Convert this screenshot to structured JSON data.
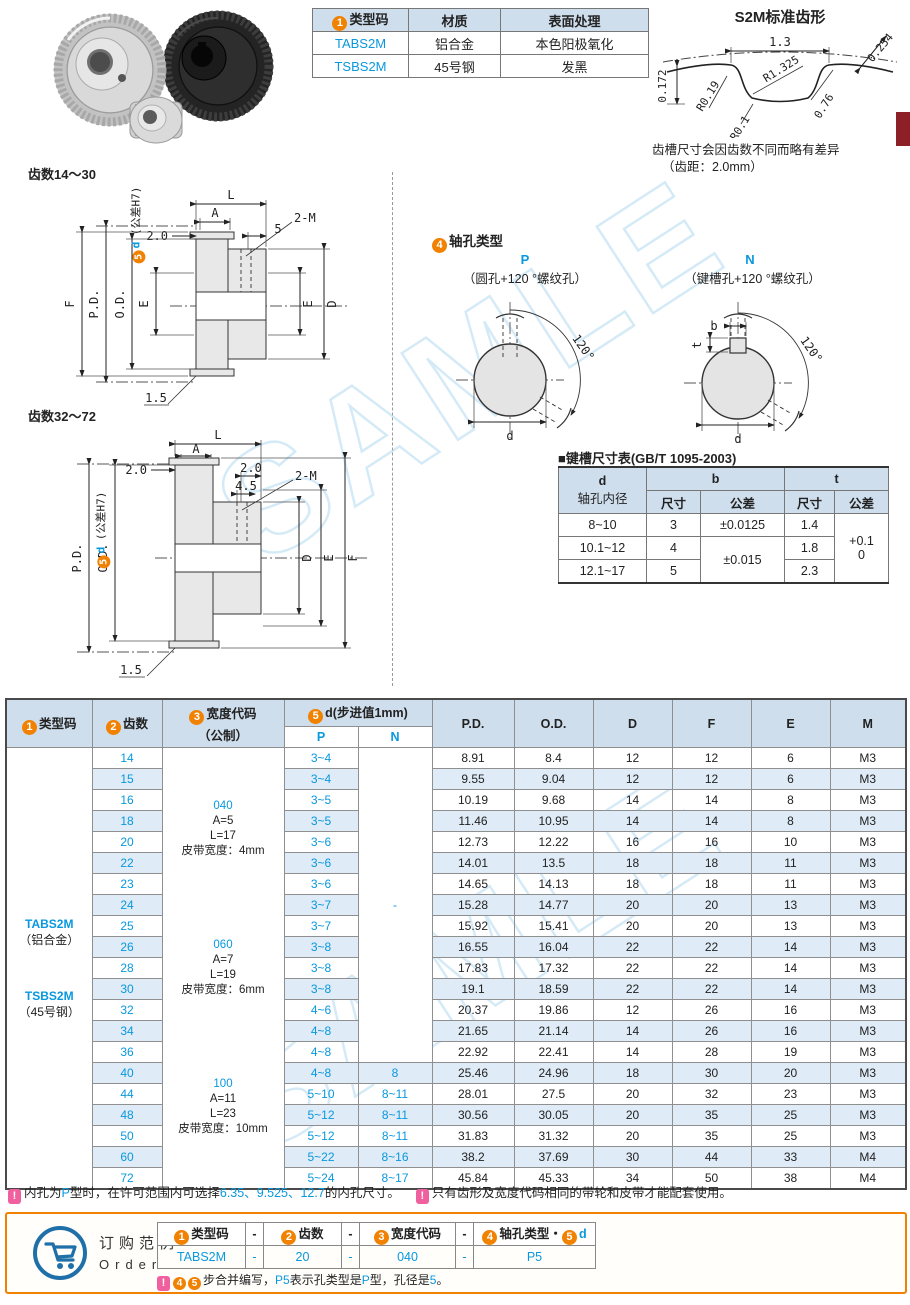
{
  "watermark": {
    "text": "SAMLE"
  },
  "spec_table": {
    "h1_num": "1",
    "h1": "类型码",
    "h2": "材质",
    "h3": "表面处理",
    "rows": [
      {
        "code": "TABS2M",
        "material": "铝合金",
        "finish": "本色阳极氧化"
      },
      {
        "code": "TSBS2M",
        "material": "45号钢",
        "finish": "发黑"
      }
    ]
  },
  "tooth_profile": {
    "title": "S2M标准齿形",
    "pitch": "1.3",
    "backlash": "0.254",
    "r_main": "R1.325",
    "r_left": "R0.19",
    "flank": "0.76",
    "height": "0.172",
    "r_bottom": "R0.1",
    "note1": "齿槽尺寸会因齿数不同而略有差异",
    "note2": "（齿距：2.0mm）"
  },
  "drawing_small": {
    "title": "齿数14～30",
    "l": "L",
    "a": "A",
    "left": "2.0",
    "right": "5",
    "screw": "2-M",
    "f": "F",
    "pd": "P.D.",
    "od": "O.D.",
    "e_left": "E",
    "e_right": "E",
    "d": "D",
    "flange": "1.5",
    "bore_num": "5",
    "bore_d": "d",
    "bore_tol": "(公差H7)"
  },
  "drawing_large": {
    "title": "齿数32～72",
    "l": "L",
    "a": "A",
    "left": "2.0",
    "right": "2.0",
    "right2": "4.5",
    "screw": "2-M",
    "f": "F",
    "pd": "P.D.",
    "od": "O.D.",
    "e": "E",
    "d": "D",
    "flange": "1.5",
    "bore_num": "5",
    "bore_d": "d",
    "bore_tol": "(公差H7)"
  },
  "shaft_hole": {
    "num": "4",
    "heading": "轴孔类型",
    "p": {
      "code": "P",
      "desc": "（圆孔+120 °螺纹孔）",
      "angle": "120°",
      "dim_d": "d"
    },
    "n": {
      "code": "N",
      "desc": "（键槽孔+120 °螺纹孔）",
      "angle": "120°",
      "dim_d": "d",
      "dim_b": "b",
      "dim_t": "t"
    }
  },
  "keyway_table": {
    "title": "■键槽尺寸表(GB/T 1095-2003)",
    "h_d": "d",
    "h_d2": "轴孔内径",
    "h_b": "b",
    "h_t": "t",
    "h_size": "尺寸",
    "h_tol": "公差",
    "rows": [
      {
        "d": "8~10",
        "b": "3",
        "t": "1.4"
      },
      {
        "d": "10.1~12",
        "b": "4",
        "t": "1.8"
      },
      {
        "d": "12.1~17",
        "b": "5",
        "t": "2.3"
      }
    ],
    "b_tol_row1": "±0.0125",
    "b_tol_row23": "±0.015",
    "t_tol_line1": "+0.1",
    "t_tol_line2": "0"
  },
  "main_table": {
    "h_type_num": "1",
    "h_type": "类型码",
    "h_teeth_num": "2",
    "h_teeth": "齿数",
    "h_width_num": "3",
    "h_width": "宽度代码",
    "h_width2": "（公制）",
    "h_d_num": "5",
    "h_d": "d(步进值1mm)",
    "h_p": "P",
    "h_n": "N",
    "h_cols": [
      "P.D.",
      "O.D.",
      "D",
      "F",
      "E",
      "M"
    ],
    "type_block": {
      "code1": "TABS2M",
      "mat1": "（铝合金）",
      "code2": "TSBS2M",
      "mat2": "（45号钢）"
    },
    "width_blocks": [
      {
        "code": "040",
        "a": "A=5",
        "l": "L=17",
        "belt": "皮带宽度：4mm"
      },
      {
        "code": "060",
        "a": "A=7",
        "l": "L=19",
        "belt": "皮带宽度：6mm"
      },
      {
        "code": "100",
        "a": "A=11",
        "l": "L=23",
        "belt": "皮带宽度：10mm"
      }
    ],
    "n_merged": "-",
    "rows": [
      {
        "teeth": "14",
        "p": "3~4",
        "pd": "8.91",
        "od": "8.4",
        "d": "12",
        "f": "12",
        "e": "6",
        "m": "M3"
      },
      {
        "teeth": "15",
        "p": "3~4",
        "pd": "9.55",
        "od": "9.04",
        "d": "12",
        "f": "12",
        "e": "6",
        "m": "M3"
      },
      {
        "teeth": "16",
        "p": "3~5",
        "pd": "10.19",
        "od": "9.68",
        "d": "14",
        "f": "14",
        "e": "8",
        "m": "M3"
      },
      {
        "teeth": "18",
        "p": "3~5",
        "pd": "11.46",
        "od": "10.95",
        "d": "14",
        "f": "14",
        "e": "8",
        "m": "M3"
      },
      {
        "teeth": "20",
        "p": "3~6",
        "pd": "12.73",
        "od": "12.22",
        "d": "16",
        "f": "16",
        "e": "10",
        "m": "M3"
      },
      {
        "teeth": "22",
        "p": "3~6",
        "pd": "14.01",
        "od": "13.5",
        "d": "18",
        "f": "18",
        "e": "11",
        "m": "M3"
      },
      {
        "teeth": "23",
        "p": "3~6",
        "pd": "14.65",
        "od": "14.13",
        "d": "18",
        "f": "18",
        "e": "11",
        "m": "M3"
      },
      {
        "teeth": "24",
        "p": "3~7",
        "pd": "15.28",
        "od": "14.77",
        "d": "20",
        "f": "20",
        "e": "13",
        "m": "M3"
      },
      {
        "teeth": "25",
        "p": "3~7",
        "pd": "15.92",
        "od": "15.41",
        "d": "20",
        "f": "20",
        "e": "13",
        "m": "M3"
      },
      {
        "teeth": "26",
        "p": "3~8",
        "pd": "16.55",
        "od": "16.04",
        "d": "22",
        "f": "22",
        "e": "14",
        "m": "M3"
      },
      {
        "teeth": "28",
        "p": "3~8",
        "pd": "17.83",
        "od": "17.32",
        "d": "22",
        "f": "22",
        "e": "14",
        "m": "M3"
      },
      {
        "teeth": "30",
        "p": "3~8",
        "pd": "19.1",
        "od": "18.59",
        "d": "22",
        "f": "22",
        "e": "14",
        "m": "M3"
      },
      {
        "teeth": "32",
        "p": "4~6",
        "pd": "20.37",
        "od": "19.86",
        "d": "12",
        "f": "26",
        "e": "16",
        "m": "M3"
      },
      {
        "teeth": "34",
        "p": "4~8",
        "pd": "21.65",
        "od": "21.14",
        "d": "14",
        "f": "26",
        "e": "16",
        "m": "M3"
      },
      {
        "teeth": "36",
        "p": "4~8",
        "pd": "22.92",
        "od": "22.41",
        "d": "14",
        "f": "28",
        "e": "19",
        "m": "M3"
      },
      {
        "teeth": "40",
        "p": "4~8",
        "n": "8",
        "pd": "25.46",
        "od": "24.96",
        "d": "18",
        "f": "30",
        "e": "20",
        "m": "M3"
      },
      {
        "teeth": "44",
        "p": "5~10",
        "n": "8~11",
        "pd": "28.01",
        "od": "27.5",
        "d": "20",
        "f": "32",
        "e": "23",
        "m": "M3"
      },
      {
        "teeth": "48",
        "p": "5~12",
        "n": "8~11",
        "pd": "30.56",
        "od": "30.05",
        "d": "20",
        "f": "35",
        "e": "25",
        "m": "M3"
      },
      {
        "teeth": "50",
        "p": "5~12",
        "n": "8~11",
        "pd": "31.83",
        "od": "31.32",
        "d": "20",
        "f": "35",
        "e": "25",
        "m": "M3"
      },
      {
        "teeth": "60",
        "p": "5~22",
        "n": "8~16",
        "pd": "38.2",
        "od": "37.69",
        "d": "30",
        "f": "44",
        "e": "33",
        "m": "M4"
      },
      {
        "teeth": "72",
        "p": "5~24",
        "n": "8~17",
        "pd": "45.84",
        "od": "45.33",
        "d": "34",
        "f": "50",
        "e": "38",
        "m": "M4"
      }
    ]
  },
  "notes": {
    "bang": "!",
    "note1_segments": [
      {
        "t": "内孔为"
      },
      {
        "t": "P",
        "blue": true
      },
      {
        "t": "型时，在许可范围内可选择"
      },
      {
        "t": "6.35、9.525、12.7",
        "blue": true
      },
      {
        "t": "的内孔尺寸。"
      }
    ],
    "note2_segments": [
      {
        "t": "只有齿形及宽度代码相同的带轮和皮带才能配套使用。"
      }
    ]
  },
  "order": {
    "label_cn": "订购范例",
    "label_en": "Order",
    "h1_num": "1",
    "h1": "类型码",
    "h2_num": "2",
    "h2": "齿数",
    "h3_num": "3",
    "h3": "宽度代码",
    "h4_num": "4",
    "h4": "轴孔类型・",
    "h4b_num": "5",
    "h4b": "d",
    "dash": "-",
    "v1": "TABS2M",
    "v2": "20",
    "v3": "040",
    "v4": "P5",
    "bang": "!",
    "note_num1": "4",
    "note_num2": "5",
    "note_segments": [
      {
        "t": "步合并编写，"
      },
      {
        "t": "P5",
        "blue": true
      },
      {
        "t": "表示孔类型是"
      },
      {
        "t": "P",
        "blue": true
      },
      {
        "t": "型，孔径是"
      },
      {
        "t": "5",
        "blue": true
      },
      {
        "t": "。"
      }
    ]
  }
}
